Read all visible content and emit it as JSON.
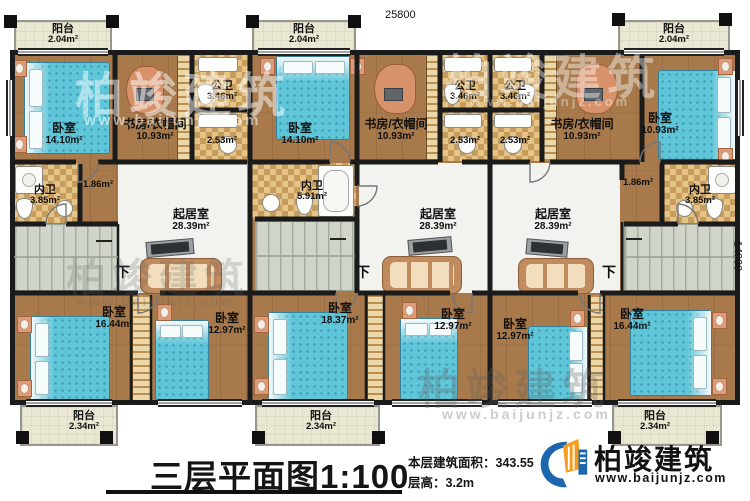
{
  "dimensions": {
    "top": "25800",
    "right": "14000"
  },
  "labels": {
    "down": "下"
  },
  "rooms": {
    "u1": {
      "balcony_top": {
        "name": "阳台",
        "area": "2.04m²"
      },
      "bedroom_main": {
        "name": "卧室",
        "area": "14.10m²"
      },
      "study": {
        "name": "书房/衣帽间",
        "area": "10.93m²"
      },
      "bath_public": {
        "name": "公卫",
        "area": "3.46m²"
      },
      "bath_small": {
        "area": "2.53m²"
      },
      "bath_ensuite": {
        "name": "内卫",
        "area": "3.85m²"
      },
      "hall": {
        "area": "1.86m²"
      },
      "living": {
        "name": "起居室",
        "area": "28.39m²"
      },
      "bedroom_b1": {
        "name": "卧室",
        "area": "16.44m²"
      },
      "bedroom_b2": {
        "name": "卧室",
        "area": "12.97m²"
      },
      "balcony_bottom": {
        "name": "阳台",
        "area": "2.34m²"
      }
    },
    "u2": {
      "balcony_top": {
        "name": "阳台",
        "area": "2.04m²"
      },
      "bedroom_main": {
        "name": "卧室",
        "area": "14.10m²"
      },
      "study": {
        "name": "书房/衣帽间",
        "area": "10.93m²"
      },
      "bath_public": {
        "name": "公卫",
        "area": "3.46m²"
      },
      "bath_small": {
        "area": "2.53m²"
      },
      "bath_ensuite": {
        "name": "内卫",
        "area": "5.91m²"
      },
      "living": {
        "name": "起居室",
        "area": "28.39m²"
      },
      "bedroom_b1": {
        "name": "卧室",
        "area": "18.37m²"
      },
      "bedroom_b2": {
        "name": "卧室",
        "area": "12.97m²"
      },
      "balcony_bottom": {
        "name": "阳台",
        "area": "2.34m²"
      }
    },
    "u3": {
      "balcony_top": {
        "name": "阳台",
        "area": "2.04m²"
      },
      "bedroom_main": {
        "name": "卧室",
        "area": "10.93m²"
      },
      "study": {
        "name": "书房/衣帽间",
        "area": "10.93m²"
      },
      "bath_public": {
        "name": "公卫",
        "area": "3.46m²"
      },
      "bath_small": {
        "area": "2.53m²"
      },
      "bath_ensuite": {
        "name": "内卫",
        "area": "3.85m²"
      },
      "hall": {
        "area": "1.86m²"
      },
      "living": {
        "name": "起居室",
        "area": "28.39m²"
      },
      "bedroom_b1": {
        "name": "卧室",
        "area": "12.97m²"
      },
      "bedroom_b2": {
        "name": "卧室",
        "area": "16.44m²"
      },
      "balcony_bottom": {
        "name": "阳台",
        "area": "2.34m²"
      }
    }
  },
  "footer": {
    "title": "三层平面图",
    "scale": "1:100",
    "area_label": "本层建筑面积：",
    "area_value": "343.55",
    "height_label": "层高：",
    "height_value": "3.2m"
  },
  "brand": {
    "name": "柏竣建筑",
    "url": "www.baijunjz.com"
  },
  "watermark": {
    "text": "柏竣建筑",
    "url": "www.baijunjz.com"
  },
  "colors": {
    "wall": "#1b1b1b",
    "wood": "#a87a4b",
    "living": "#f2f3ee",
    "stair": "#cfd5c9",
    "checker": "#e6c488",
    "balcony": "#eae7d2",
    "bed": "#5fc6d9",
    "brand_blue": "#1b66ad",
    "brand_orange": "#f39c1f"
  }
}
